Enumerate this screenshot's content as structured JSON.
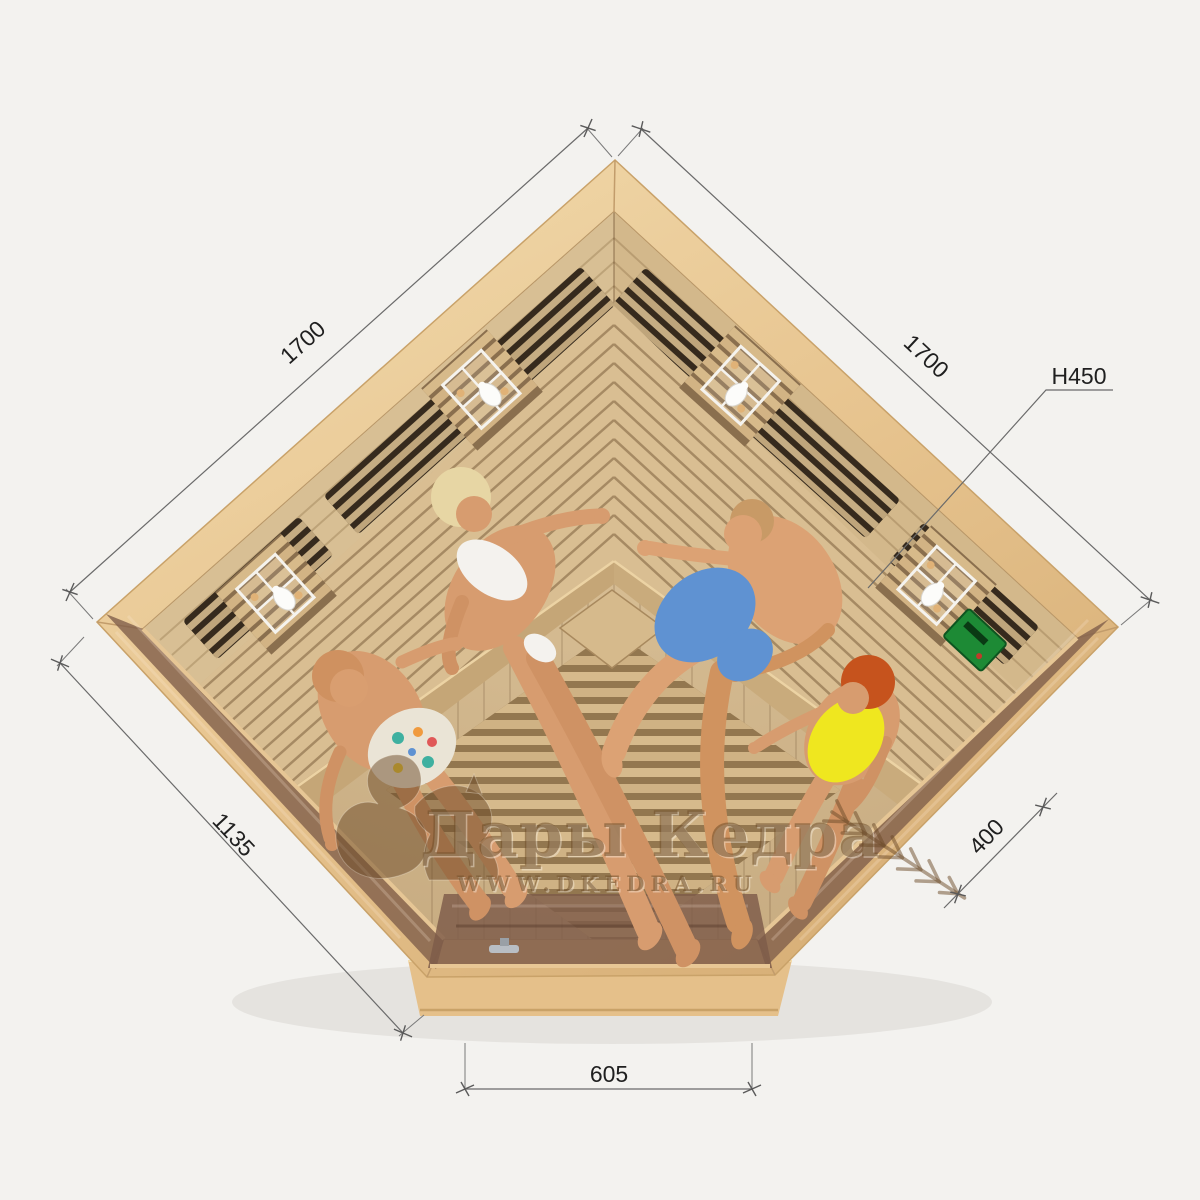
{
  "dimensions": {
    "top_left": "1700",
    "top_right": "1700",
    "height": "H450",
    "left_front": "1135",
    "right_front": "400",
    "door": "605"
  },
  "watermark": {
    "brand": "Дары Кедра",
    "url": "WWW.DKEDRA.RU"
  },
  "colors": {
    "background": "#f3f2ef",
    "wood_band": "#e9cb9b",
    "wood_band_dark": "#dcb67f",
    "interior_floor": "#cfb389",
    "bench_wood": "#d9be92",
    "heater_panel": "#362a1d",
    "heater_slat": "#d3b88c",
    "glass_tint": "#7e5c49",
    "frame_trim": "#e6c695",
    "base_wood": "#e5c08a",
    "control_panel_green": "#1d8a35",
    "dimension_line": "#6a6a6a",
    "dimension_text": "#1f1f1f",
    "watermark_brown": "#704e2a"
  },
  "figures": [
    {
      "name": "woman-blonde-white-bikini",
      "swimwear": "#f4f2ee",
      "hair": "#e7d6a4",
      "skin": "#d79c6f"
    },
    {
      "name": "man-blue-shorts",
      "swimwear": "#5f92d2",
      "hair": "#c89a66",
      "skin": "#dca274"
    },
    {
      "name": "man-floral-shorts",
      "swimwear": "#eae4d6",
      "hair": "#cf9160",
      "skin": "#d79c6f"
    },
    {
      "name": "woman-yellow-swimsuit",
      "swimwear": "#efe71f",
      "hair": "#c6531d",
      "skin": "#d79c6f"
    }
  ],
  "equipment": {
    "lamps": "4",
    "control_panel": "control-panel-green",
    "door_handle": "door-handle"
  }
}
